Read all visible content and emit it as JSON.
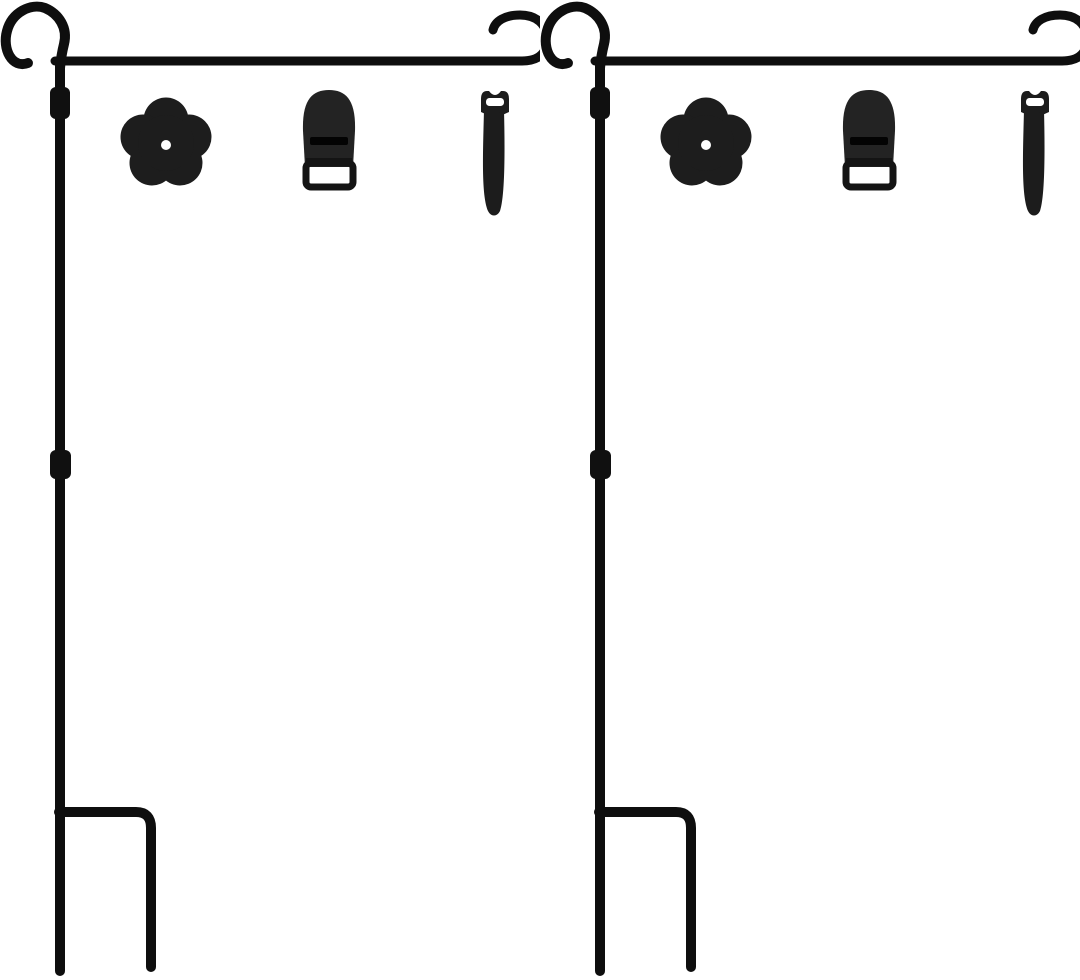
{
  "scene": {
    "type": "product-photo",
    "item_count": 2,
    "description": "Two identical black wrought-iron garden flag stands shown side by side on a white background, each with a flower-shaped rubber stopper, a dome clip with strap buckle, and a hook-and-loop tie strap"
  },
  "colors": {
    "background": "#ffffff",
    "metal": "#0e0e0e",
    "metal_joint": "#101010",
    "flower": "#1d1d1d",
    "flower_hole": "#ffffff",
    "clip_body": "#232323",
    "clip_slot": "#030303",
    "clip_buckle": "#141414",
    "tie": "#1c1c1c",
    "tie_slot": "#ffffff"
  },
  "kits": [
    {
      "id": "kit-1",
      "stand": "garden flag stand pole with curled loop top, hanger arm with anti-slip end hook, two pole joint sleeves, H-shaped ground fork",
      "accessories": [
        "flower rubber stopper with center hole",
        "flag clip with buckle",
        "hook-and-loop tie strap"
      ]
    },
    {
      "id": "kit-2",
      "stand": "garden flag stand pole with curled loop top, hanger arm with anti-slip end hook, two pole joint sleeves, H-shaped ground fork",
      "accessories": [
        "flower rubber stopper with center hole",
        "flag clip with buckle",
        "hook-and-loop tie strap"
      ]
    }
  ]
}
